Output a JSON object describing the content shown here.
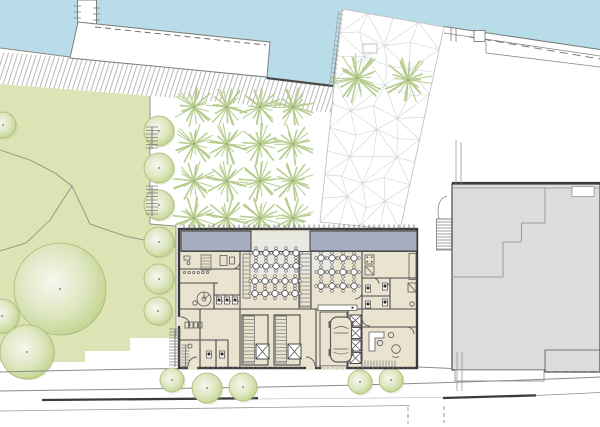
{
  "colors": {
    "water": "#b9dde8",
    "land": "#ffffff",
    "quay_line": "#7d7d7d",
    "dash_line": "#6f6f6f",
    "seawall": "#4a4a4a",
    "park": "#dde3b4",
    "park_edge": "#8b8b80",
    "path_line": "#8a8a80",
    "tree_center": "#f6f7ee",
    "tree_mid": "#dfe7c2",
    "tree_outer": "#c3d48e",
    "tree_edge": "#a9ba78",
    "burst": "#b4cb8b",
    "burst_dot": "#93a968",
    "hatch": "#9a9a9a",
    "mesh": "#cfcfcf",
    "wall": "#3a3a3a",
    "wall_thin": "#4a4a4a",
    "floor": "#eae3d0",
    "terrace": "#e9e9e4",
    "roof": "#a6aec0",
    "furniture": "#5a5a5a",
    "fixture": "#777777",
    "gray_building": "#dcdcda",
    "gray_line": "#585858",
    "gray_inner": "#9a9a9a",
    "road": "#8c8c8c",
    "road_dark": "#3b3b3b"
  },
  "scene": {
    "street_trees": [
      [
        172,
        380,
        12
      ],
      [
        207,
        388,
        15
      ],
      [
        243,
        387,
        14
      ],
      [
        360,
        382,
        12
      ],
      [
        391,
        380,
        12
      ]
    ],
    "park_trees": [
      [
        60,
        289,
        46
      ],
      [
        27,
        352,
        27
      ],
      [
        2,
        316,
        17
      ],
      [
        3,
        125,
        13
      ],
      [
        158,
        311,
        14
      ]
    ],
    "column_trees": {
      "x": 159,
      "ys": [
        131,
        168,
        205,
        242,
        279
      ],
      "r": 15
    },
    "burst_grid": {
      "cols": [
        194,
        227,
        260,
        293
      ],
      "rows": [
        107,
        144,
        181,
        218
      ],
      "r": 21
    },
    "plaza_bursts": [
      [
        357,
        78,
        26
      ],
      [
        408,
        80,
        24
      ]
    ],
    "mesh": {
      "quad": [
        [
          342,
          9
        ],
        [
          444,
          27
        ],
        [
          400,
          230
        ],
        [
          320,
          222
        ]
      ],
      "nu": 4,
      "nv": 9,
      "jitter": 5
    },
    "tables": [
      {
        "x0": 256,
        "y0": 253,
        "cols": 5,
        "rows": 2,
        "dx": 10,
        "dy": 13,
        "r": 3.1
      },
      {
        "x0": 255,
        "y0": 281,
        "cols": 5,
        "rows": 2,
        "dx": 10,
        "dy": 12.5,
        "r": 3.1
      },
      {
        "x0": 321,
        "y0": 258,
        "cols": 4,
        "rows": 3,
        "dx": 11,
        "dy": 14,
        "r": 3.1
      }
    ],
    "rungs": [
      {
        "x": 300,
        "y": 254,
        "w": 10.5,
        "h": 53,
        "s": 4,
        "o": "h",
        "rail": true
      },
      {
        "x": 243.5,
        "y": 316,
        "w": 11,
        "h": 47,
        "s": 3.5,
        "o": "h",
        "rail": true
      },
      {
        "x": 275.5,
        "y": 316,
        "w": 11,
        "h": 47,
        "s": 3.5,
        "o": "h",
        "rail": true
      },
      {
        "x": 201,
        "y": 255,
        "w": 10,
        "h": 15,
        "s": 3,
        "o": "h",
        "rail": true
      },
      {
        "x": 243,
        "y": 254,
        "w": 7,
        "h": 44,
        "s": 4,
        "o": "h",
        "rail": true
      },
      {
        "x": 362,
        "y": 360.5,
        "w": 34,
        "h": 7,
        "s": 3,
        "o": "v",
        "rail": false
      },
      {
        "x": 169,
        "y": 329,
        "w": 12,
        "h": 38,
        "s": 3,
        "o": "h",
        "rail": false,
        "spine": true
      },
      {
        "x": 181.5,
        "y": 345,
        "w": 8,
        "h": 21,
        "s": 3,
        "o": "h",
        "rail": false,
        "spine": true
      },
      {
        "x": 146,
        "y": 127,
        "w": 12,
        "h": 22,
        "s": 3.5,
        "o": "h",
        "rail": false,
        "spine": true
      },
      {
        "x": 146,
        "y": 186,
        "w": 12,
        "h": 30,
        "s": 3.5,
        "o": "h",
        "rail": false,
        "spine": true
      },
      {
        "x": 436.5,
        "y": 219,
        "w": 15,
        "h": 31,
        "s": 3,
        "o": "h",
        "rail": true
      }
    ],
    "xboxes": [
      [
        256,
        344,
        13,
        15
      ],
      [
        288,
        344,
        13,
        15
      ],
      [
        350,
        315,
        11,
        11
      ],
      [
        350,
        327.5,
        11,
        11
      ],
      [
        350,
        340,
        11,
        11
      ],
      [
        350,
        352.5,
        11,
        11
      ]
    ],
    "hooks": {
      "x0": 184.5,
      "y": 272.5,
      "n": 6,
      "dx": 4.6,
      "r": 1.2
    },
    "wc": [
      [
        219,
        298
      ],
      [
        227,
        298
      ],
      [
        235,
        298
      ],
      [
        368,
        286
      ],
      [
        368,
        302
      ],
      [
        385,
        284
      ],
      [
        385,
        300
      ],
      [
        209,
        352
      ],
      [
        222,
        352
      ]
    ],
    "facade_ticks": {
      "top": {
        "x0": 184,
        "x1": 414,
        "y0": 224.5,
        "y1": 229.5,
        "s": 5
      },
      "bottom": {
        "x0": 183,
        "x1": 415,
        "y0": 366.5,
        "y1": 369.8,
        "s": 5
      }
    },
    "pier_ticks": [
      6,
      12,
      18
    ]
  }
}
